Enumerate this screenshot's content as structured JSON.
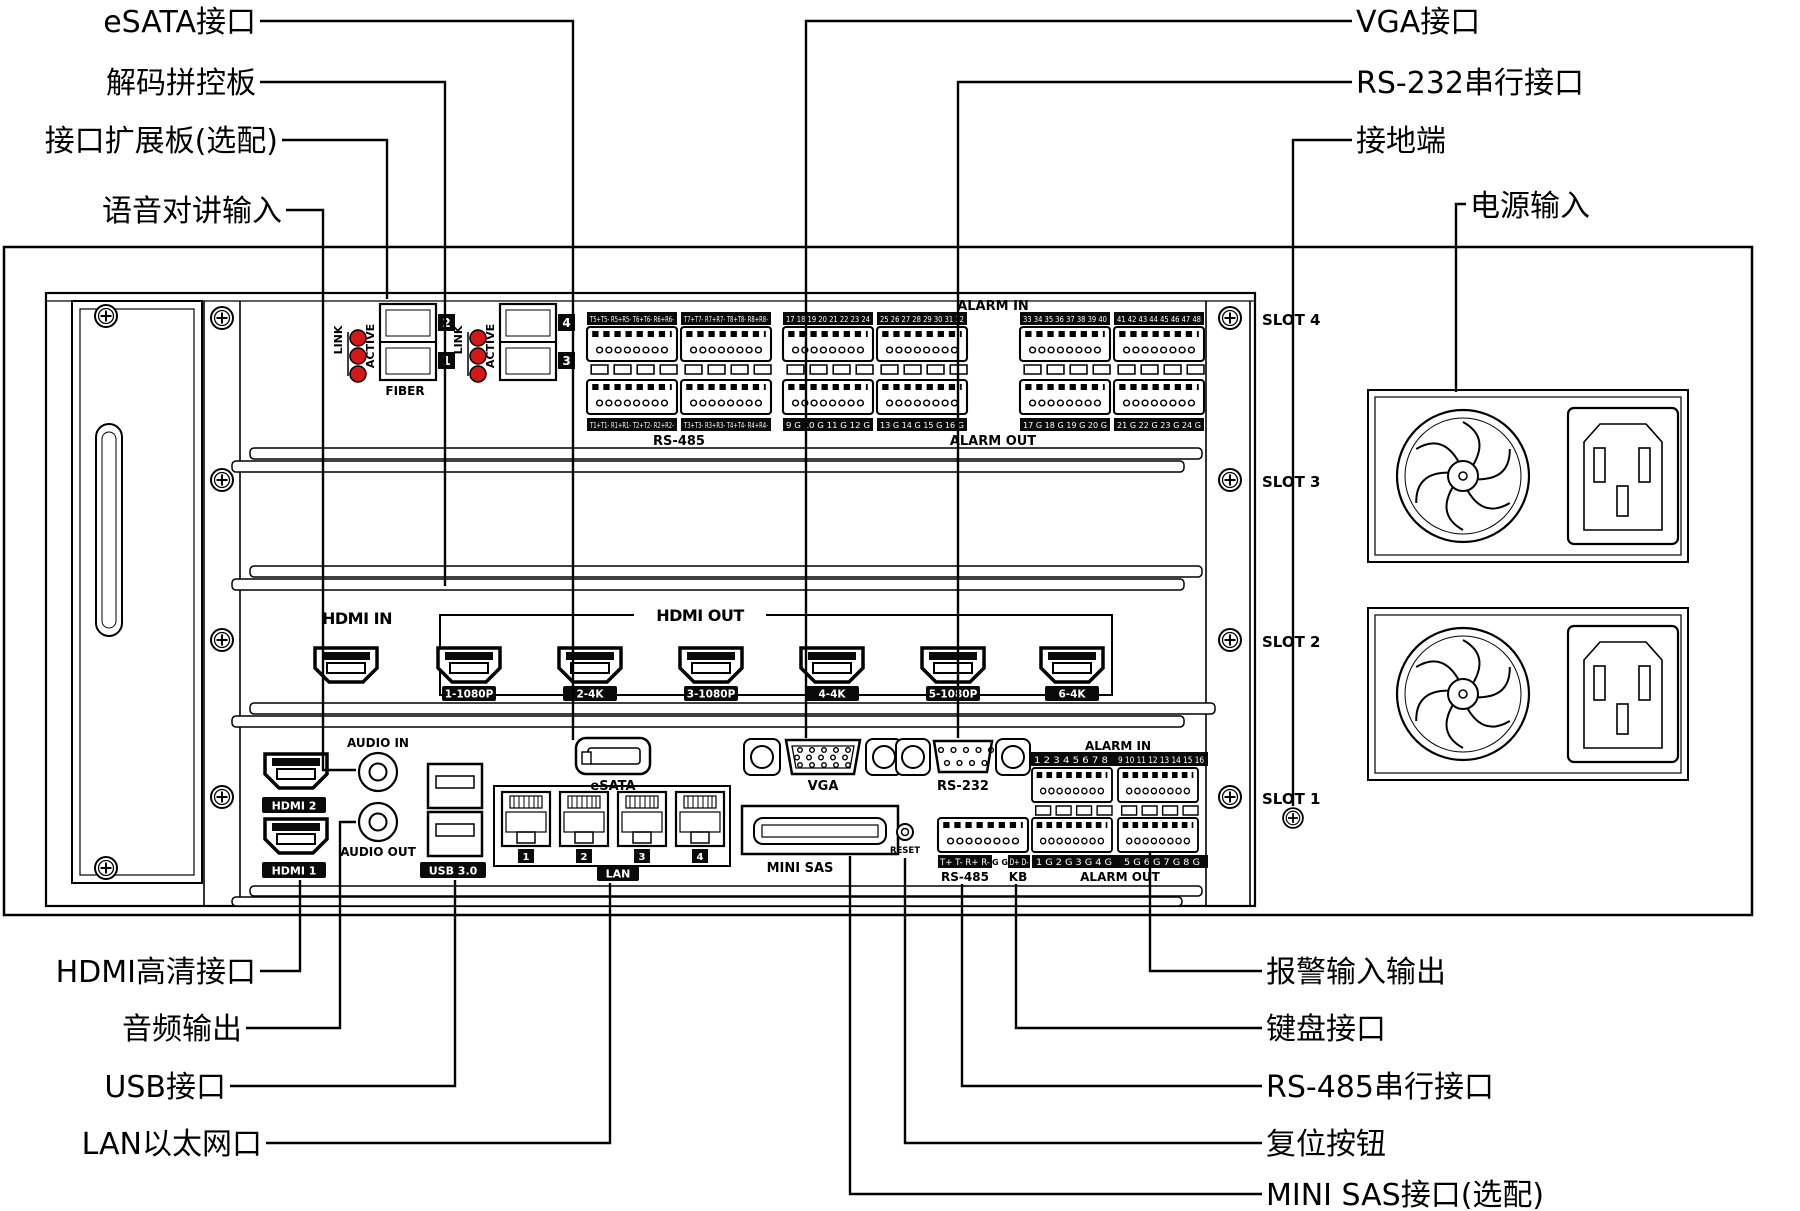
{
  "callouts": {
    "top_left": [
      "eSATA接口",
      "解码拼控板",
      "接口扩展板(选配)",
      "语音对讲输入"
    ],
    "top_right": [
      "VGA接口",
      "RS-232串行接口",
      "接地端",
      "电源输入"
    ],
    "bottom_left": [
      "HDMI高清接口",
      "音频输出",
      "USB接口",
      "LAN以太网口"
    ],
    "bottom_right": [
      "报警输入输出",
      "键盘接口",
      "RS-485串行接口",
      "复位按钮",
      "MINI SAS接口(选配)"
    ]
  },
  "chassis": {
    "slot_labels": [
      "SLOT 4",
      "SLOT 3",
      "SLOT 2",
      "SLOT 1"
    ],
    "expansion_card": {
      "fiber_label": "FIBER",
      "link_label": "LINK",
      "active_label": "ACTIVE",
      "module_numbers": [
        "2",
        "1",
        "4",
        "3"
      ],
      "rs485": {
        "top_headers": [
          "T5+T5- R5+R5- T6+T6- R6+R6-",
          "T7+T7- R7+R7- T8+T8- R8+R8-"
        ],
        "bottom_headers": [
          "T1+T1- R1+R1- T2+T2- R2+R2-",
          "T3+T3- R3+R3- T4+T4- R4+R4-"
        ],
        "label": "RS-485"
      },
      "alarm": {
        "title": "ALARM IN",
        "in_headers": [
          "17 18 19 20 21 22 23 24",
          "25 26 27 28 29 30 31 32",
          "33 34 35 36 37 38 39 40",
          "41 42 43 44 45 46 47 48"
        ],
        "out_headers": [
          "9 G 10 G 11 G 12 G",
          "13 G 14 G 15 G 16 G",
          "17 G 18 G 19 G 20 G",
          "21 G 22 G 23 G 24 G"
        ],
        "label": "ALARM OUT"
      }
    },
    "decode_card": {
      "hdmi_in_label": "HDMI IN",
      "hdmi_out_label": "HDMI OUT",
      "hdmi_out_ports": [
        "1-1080P",
        "2-4K",
        "3-1080P",
        "4-4K",
        "5-1080P",
        "6-4K"
      ]
    },
    "main_board": {
      "hdmi_chips": [
        "HDMI 2",
        "HDMI 1"
      ],
      "audio_in": "AUDIO IN",
      "audio_out": "AUDIO OUT",
      "usb": "USB 3.0",
      "lan_numbers": [
        "1",
        "2",
        "3",
        "4"
      ],
      "lan_label": "LAN",
      "esata": "eSATA",
      "vga": "VGA",
      "rs232": "RS-232",
      "mini_sas": "MINI SAS",
      "reset": "RESET",
      "alarm_in_title": "ALARM IN",
      "alarm_in_headers": [
        "1 2 3 4 5 6 7 8",
        "9 10 11 12 13 14 15 16"
      ],
      "rs485_header": "T+ T- R+ R-",
      "gnd_header": "G G",
      "kb_header": "D+ D-",
      "rs485_label": "RS-485",
      "kb_label": "KB",
      "alarm_out_headers": [
        "1 G 2 G 3 G 4 G",
        "5 G 6 G 7 G 8 G"
      ],
      "alarm_out_label": "ALARM OUT"
    },
    "colors": {
      "led_red": "#d41717",
      "label_chip": "#0a0a0a",
      "line": "#000000",
      "background": "#ffffff"
    }
  }
}
